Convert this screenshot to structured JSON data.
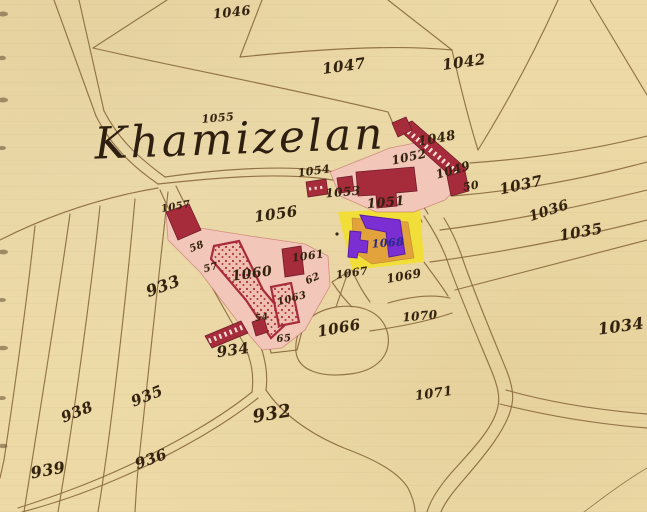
{
  "map": {
    "title": "Khamizelan",
    "colors": {
      "background": "#ecd9a5",
      "line": "#8a6a3f",
      "ink": "#33220f",
      "building": "#a62c3c",
      "building_light": "#f2c6b8",
      "stipple_fill": "#efc0af",
      "stipple_dot": "#b23247",
      "highlight_yellow": "#f2de39",
      "highlight_orange": "#e2a33c",
      "highlight_purple": "#7b2fd2",
      "highlight_ink": "#28288e"
    },
    "labels": [
      {
        "text": "1046",
        "x": 232,
        "y": 13,
        "size": 13,
        "rot": -6
      },
      {
        "text": "1047",
        "x": 344,
        "y": 66,
        "size": 15,
        "rot": -8
      },
      {
        "text": "1042",
        "x": 464,
        "y": 62,
        "size": 15,
        "rot": -8
      },
      {
        "text": "1055",
        "x": 218,
        "y": 118,
        "size": 11,
        "rot": -5
      },
      {
        "text": "1048",
        "x": 437,
        "y": 139,
        "size": 13,
        "rot": -10
      },
      {
        "text": "1052",
        "x": 409,
        "y": 157,
        "size": 12,
        "rot": -12
      },
      {
        "text": "1049",
        "x": 453,
        "y": 170,
        "size": 12,
        "rot": -16
      },
      {
        "text": "50",
        "x": 471,
        "y": 186,
        "size": 11,
        "rot": -10
      },
      {
        "text": "1054",
        "x": 314,
        "y": 171,
        "size": 11,
        "rot": -8
      },
      {
        "text": "1053",
        "x": 343,
        "y": 192,
        "size": 12,
        "rot": -5
      },
      {
        "text": "1051",
        "x": 386,
        "y": 203,
        "size": 13,
        "rot": -5
      },
      {
        "text": "1037",
        "x": 521,
        "y": 185,
        "size": 15,
        "rot": -12
      },
      {
        "text": "1036",
        "x": 549,
        "y": 211,
        "size": 14,
        "rot": -18
      },
      {
        "text": "1035",
        "x": 581,
        "y": 232,
        "size": 15,
        "rot": -10
      },
      {
        "text": "1034",
        "x": 621,
        "y": 326,
        "size": 16,
        "rot": -8
      },
      {
        "text": "1057",
        "x": 176,
        "y": 207,
        "size": 10,
        "rot": -10
      },
      {
        "text": "1056",
        "x": 276,
        "y": 214,
        "size": 15,
        "rot": -8
      },
      {
        "text": "58",
        "x": 197,
        "y": 247,
        "size": 10,
        "rot": -22
      },
      {
        "text": "57",
        "x": 211,
        "y": 268,
        "size": 10,
        "rot": -15
      },
      {
        "text": "1060",
        "x": 252,
        "y": 274,
        "size": 14,
        "rot": -8
      },
      {
        "text": "1061",
        "x": 308,
        "y": 256,
        "size": 11,
        "rot": -8
      },
      {
        "text": "62",
        "x": 313,
        "y": 279,
        "size": 10,
        "rot": -25
      },
      {
        "text": "1063",
        "x": 292,
        "y": 299,
        "size": 10,
        "rot": -15
      },
      {
        "text": "54",
        "x": 262,
        "y": 318,
        "size": 9,
        "rot": -10
      },
      {
        "text": "65",
        "x": 284,
        "y": 339,
        "size": 10,
        "rot": -5
      },
      {
        "text": "933",
        "x": 163,
        "y": 286,
        "size": 16,
        "rot": -20
      },
      {
        "text": "934",
        "x": 233,
        "y": 350,
        "size": 15,
        "rot": -8
      },
      {
        "text": "935",
        "x": 147,
        "y": 396,
        "size": 15,
        "rot": -22
      },
      {
        "text": "936",
        "x": 151,
        "y": 459,
        "size": 15,
        "rot": -20
      },
      {
        "text": "938",
        "x": 77,
        "y": 412,
        "size": 15,
        "rot": -22
      },
      {
        "text": "939",
        "x": 48,
        "y": 470,
        "size": 16,
        "rot": -10
      },
      {
        "text": "932",
        "x": 272,
        "y": 414,
        "size": 18,
        "rot": -10
      },
      {
        "text": "1066",
        "x": 339,
        "y": 328,
        "size": 15,
        "rot": -10
      },
      {
        "text": "1067",
        "x": 352,
        "y": 273,
        "size": 11,
        "rot": -8
      },
      {
        "text": "1068",
        "x": 388,
        "y": 243,
        "size": 11,
        "rot": -4,
        "cls": "ink-blue"
      },
      {
        "text": "1069",
        "x": 404,
        "y": 276,
        "size": 12,
        "rot": -10
      },
      {
        "text": "1070",
        "x": 420,
        "y": 316,
        "size": 12,
        "rot": -5
      },
      {
        "text": "1071",
        "x": 434,
        "y": 394,
        "size": 13,
        "rot": -8
      }
    ]
  }
}
